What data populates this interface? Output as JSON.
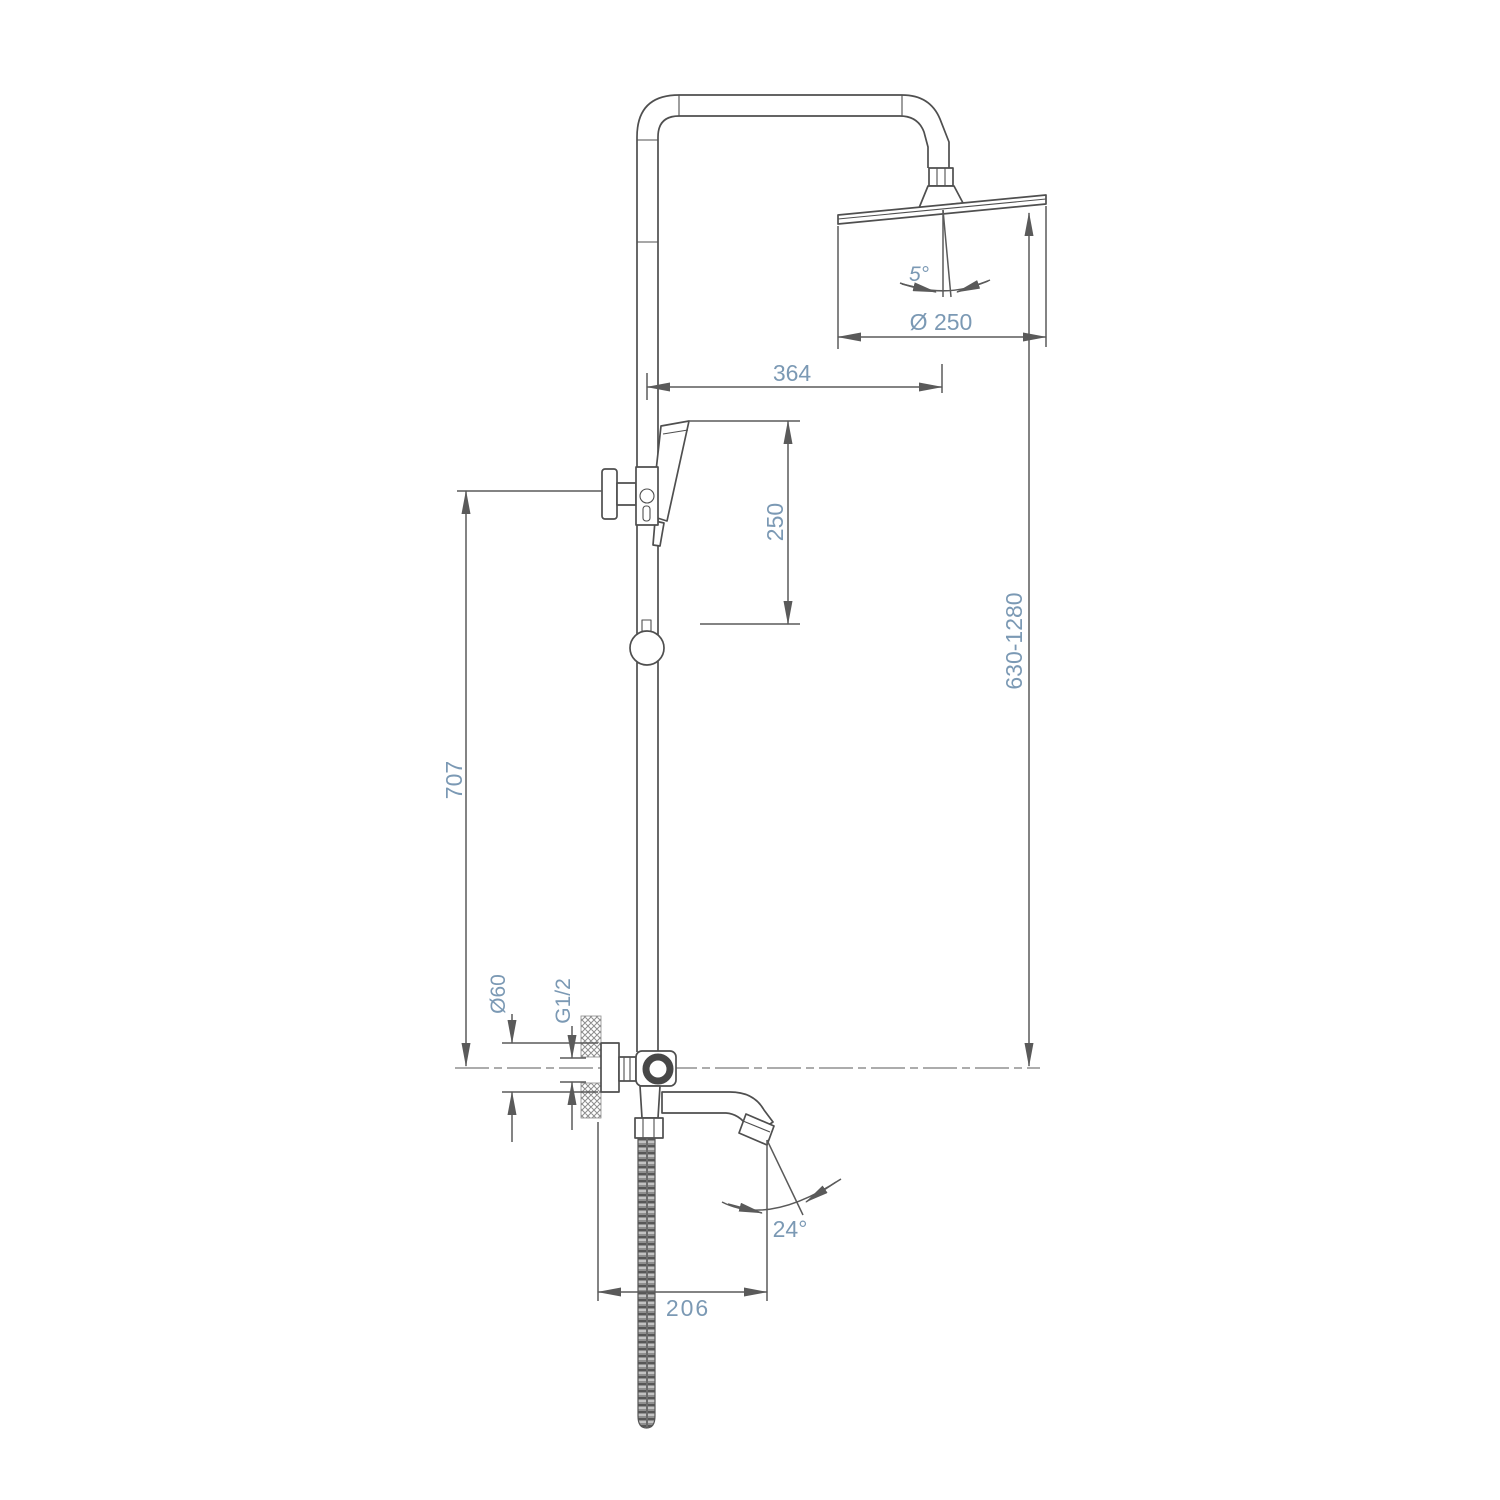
{
  "labels": {
    "head_angle": "5°",
    "head_diameter": "Ø 250",
    "arm_offset": "364",
    "handshower_travel": "250",
    "height_range": "630-1280",
    "bracket_height": "707",
    "flange_diameter": "Ø60",
    "thread_size": "G1/2",
    "spout_angle": "24°",
    "spout_reach": "206"
  },
  "colors": {
    "outline": "#4f4f4f",
    "dimension_line": "#5a5a5a",
    "dimension_text": "#7b99b4",
    "background": "#ffffff"
  }
}
